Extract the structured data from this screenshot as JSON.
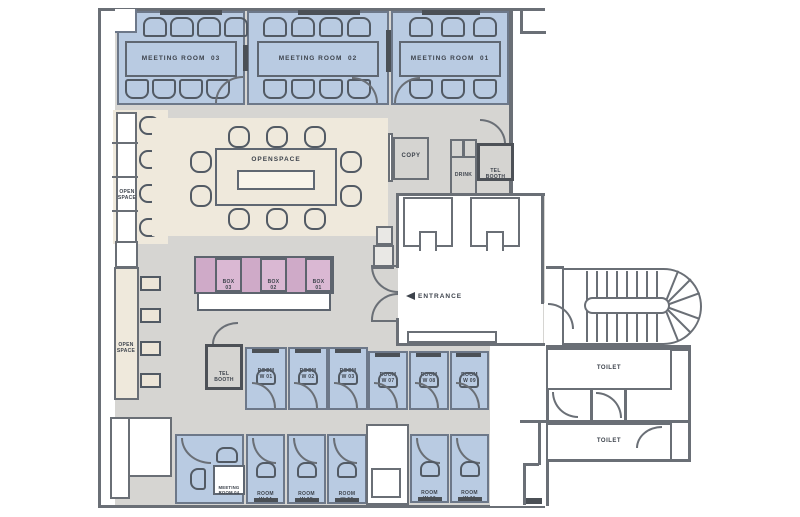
{
  "palette": {
    "room_blue": "#b9cbe2",
    "openspace_beige": "#efe9dc",
    "box_pink": "#cfaac8",
    "box_pink_light": "#dab8d3",
    "floor_gray": "#d6d5d2",
    "wall": "#6a6f76",
    "wall_dark": "#4b5056",
    "text": "#3d434c"
  },
  "labels": {
    "meeting_room_03": "MEETING ROOM  03",
    "meeting_room_02": "MEETING ROOM  02",
    "meeting_room_01": "MEETING ROOM  01",
    "meeting_room_04": {
      "l1": "MEETING",
      "l2": "ROOM 04"
    },
    "openspace": "OPENSPACE",
    "open_space_upper": {
      "l1": "OPEN",
      "l2": "SPACE"
    },
    "open_space_lower": {
      "l1": "OPEN",
      "l2": "SPACE"
    },
    "copy": "COPY",
    "drink": "DRINK",
    "tel_booth_top": {
      "l1": "TEL",
      "l2": "BOOTH"
    },
    "tel_booth_mid": {
      "l1": "TEL",
      "l2": "BOOTH"
    },
    "entrance": "ENTRANCE",
    "toilet_upper": "TOILET",
    "toilet_lower": "TOILET",
    "boxes": [
      {
        "l1": "BOX",
        "l2": "03"
      },
      {
        "l1": "BOX",
        "l2": "02"
      },
      {
        "l1": "BOX",
        "l2": "01"
      }
    ],
    "rooms_top": [
      {
        "l1": "ROOM",
        "l2": "W 01"
      },
      {
        "l1": "ROOM",
        "l2": "W 02"
      },
      {
        "l1": "ROOM",
        "l2": "W 03"
      },
      {
        "l1": "ROOM",
        "l2": "W 07"
      },
      {
        "l1": "ROOM",
        "l2": "W 08"
      },
      {
        "l1": "ROOM",
        "l2": "W 09"
      }
    ],
    "rooms_bottom": [
      {
        "l1": "ROOM",
        "l2": "W 04"
      },
      {
        "l1": "ROOM",
        "l2": "W 05"
      },
      {
        "l1": "ROOM",
        "l2": "W 06"
      },
      {
        "l1": "ROOM",
        "l2": "W 10"
      },
      {
        "l1": "ROOM",
        "l2": "W 11"
      }
    ]
  }
}
